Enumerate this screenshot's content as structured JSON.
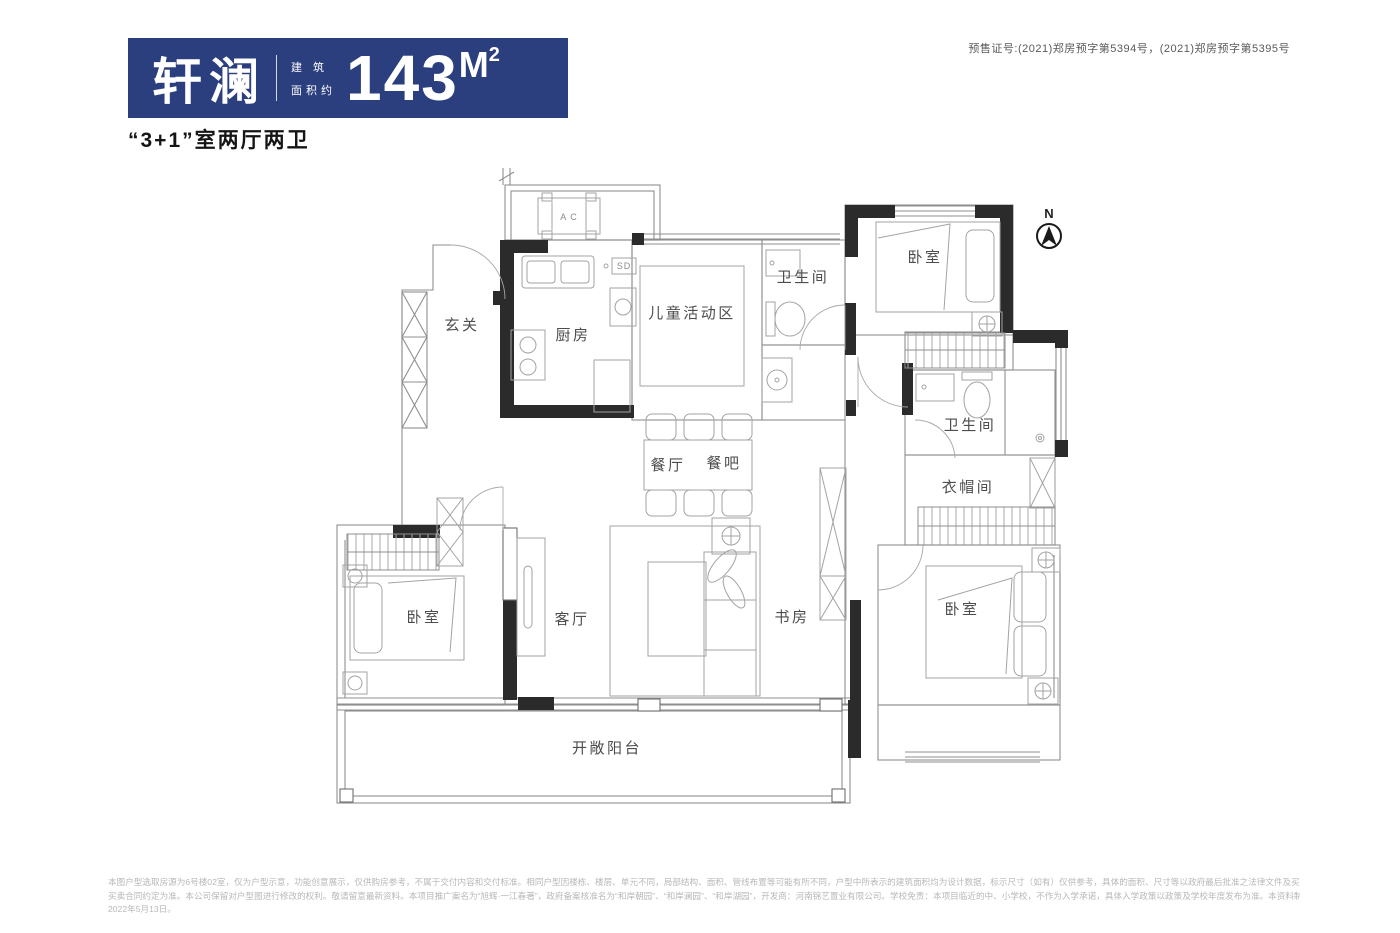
{
  "header": {
    "project_name": "轩澜",
    "area_prefix_line1": "建 筑",
    "area_prefix_line2": "面积约",
    "area_number": "143",
    "area_unit_m": "M",
    "area_unit_sup": "2",
    "subtitle": "“3+1”室两厅两卫",
    "presale_certificate": "预售证号:(2021)郑房预字第5394号，(2021)郑房预字第5395号"
  },
  "colors": {
    "brand_navy": "#2b3e7d",
    "wall_black": "#2b2b2b",
    "line_gray": "#8f8f8f",
    "label_gray": "#4d4d4d"
  },
  "floorplan": {
    "compass_label": "N",
    "ac_unit_label": "A C",
    "washer_label": "SD",
    "rooms": {
      "entry": "玄关",
      "kitchen": "厨房",
      "kids_area": "儿童活动区",
      "bathroom_top": "卫生间",
      "bedroom_top_right": "卧室",
      "dining": "餐厅",
      "dining_bar": "餐吧",
      "bathroom_right": "卫生间",
      "cloakroom": "衣帽间",
      "living": "客厅",
      "study": "书房",
      "bedroom_bottom_left": "卧室",
      "bedroom_master": "卧室",
      "balcony": "开敞阳台"
    }
  },
  "footer": {
    "line1": "本图户型选取房源为6号楼02室，仅为户型示意，功能创意展示，仅供购房参考，不属于交付内容和交付标准。相同户型因楼栋、楼层、单元不同，局部结构、面积、管线布置等可能有所不同，户型中所表示的建筑面积均为设计数据，标示尺寸（如有）仅供参考，具体的面积、尺寸等以政府最后批准之法律文件及买卖双方签订的商品房",
    "line2": "买卖合同约定为准。本公司保留对户型图进行修改的权利。敬请留意最新资料。本项目推广案名为“旭辉·一江春著”，政府备案核准名为“和岸朝园”、“和岸澜园”、“和岸湖园”，开发商：河南锦艺置业有限公司。学校免责：本项目临近的中、小学校，不作为入学承诺，具体入学政策以政策及学校年度发布为准。本资料制作时间为",
    "line3": "2022年5月13日。"
  }
}
